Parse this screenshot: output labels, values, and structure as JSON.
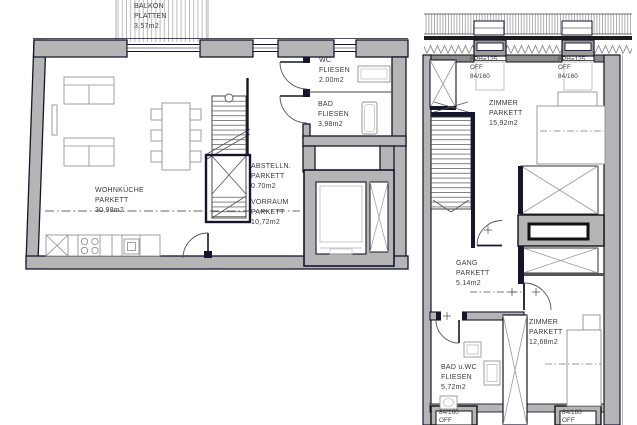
{
  "colors": {
    "background": "#ffffff",
    "wall_fill": "#b5b5b5",
    "wall_outline": "#15152e",
    "furniture_line": "#8f8f8f",
    "text": "#3a3a3a"
  },
  "left": {
    "balkon": {
      "name": "BALKON",
      "material": "PLATTEN",
      "area": "3,57m2"
    },
    "wohnkueche": {
      "name": "WOHNKÜCHE",
      "material": "PARKETT",
      "area": "30,98m2"
    },
    "wc": {
      "name": "WC",
      "material": "FLIESEN",
      "area": "2.00m2"
    },
    "bad": {
      "name": "BAD",
      "material": "FLIESEN",
      "area": "3,98m2"
    },
    "abstellraum": {
      "name": "ABSTELLN.",
      "material": "PARKETT",
      "area": "0.70m2"
    },
    "vorraum": {
      "name": "VORRAUM",
      "material": "PARKETT",
      "area": "10,72m2"
    }
  },
  "right": {
    "zimmer_top": {
      "name": "ZIMMER",
      "material": "PARKETT",
      "area": "15,92m2"
    },
    "gang": {
      "name": "GANG",
      "material": "PARKETT",
      "area": "5.14m2"
    },
    "zimmer_bottom": {
      "name": "ZIMMER",
      "material": "PARKETT",
      "area": "12,68m2"
    },
    "bad_wc": {
      "name": "BAD u.WC",
      "material": "FLIESEN",
      "area": "5,72m2"
    },
    "roof_window_left": {
      "height": "FPH=125",
      "opening": "OFF",
      "size": "84/160"
    },
    "roof_window_right": {
      "height": "FPH=125",
      "opening": "OFF",
      "size": "84/160"
    },
    "bottom_window_left": {
      "size": "84/160",
      "opening": "OFF"
    },
    "bottom_window_right": {
      "size": "84/160",
      "opening": "OFF"
    }
  }
}
